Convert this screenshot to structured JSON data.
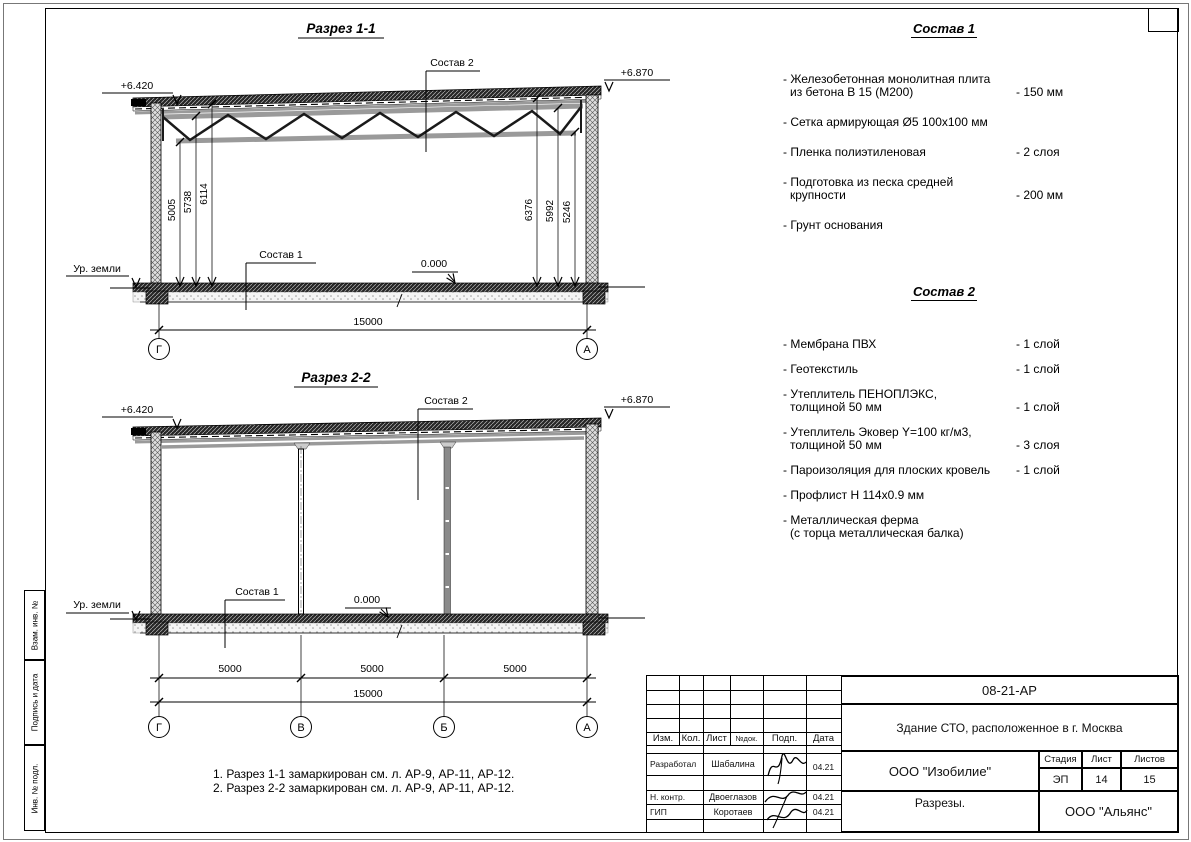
{
  "sheet": {
    "margin_label_1": "Взам. инв. №",
    "margin_label_2": "Подпись и дата",
    "margin_label_3": "Инв. № подл."
  },
  "section1": {
    "title": "Разрез 1-1",
    "level_left": "+6.420",
    "level_right": "+6.870",
    "leader_top": "Состав 2",
    "leader_floor": "Состав 1",
    "ground": "Ур. земли",
    "zero": "0.000",
    "dim_left_1": "5005",
    "dim_left_2": "5738",
    "dim_left_3": "6114",
    "dim_right_1": "6376",
    "dim_right_2": "5992",
    "dim_right_3": "5246",
    "dim_total": "15000",
    "axis_left": "Г",
    "axis_right": "А"
  },
  "section2": {
    "title": "Разрез 2-2",
    "level_left": "+6.420",
    "level_right": "+6.870",
    "leader_top": "Состав 2",
    "leader_floor": "Состав 1",
    "ground": "Ур. земли",
    "zero": "0.000",
    "span_1": "5000",
    "span_2": "5000",
    "span_3": "5000",
    "dim_total": "15000",
    "axis_1": "Г",
    "axis_2": "В",
    "axis_3": "Б",
    "axis_4": "А"
  },
  "sostav1": {
    "title": "Состав 1",
    "items": [
      {
        "line1": "- Железобетонная  монолитная плита",
        "line2": "из бетона В 15 (М200)",
        "value": "- 150 мм"
      },
      {
        "line1": "- Сетка армирующая Ø5 100x100 мм",
        "line2": "",
        "value": ""
      },
      {
        "line1": "- Пленка полиэтиленовая",
        "line2": "",
        "value": "-  2 слоя"
      },
      {
        "line1": "- Подготовка из песка средней",
        "line2": "крупности",
        "value": "- 200 мм"
      },
      {
        "line1": "- Грунт основания",
        "line2": "",
        "value": ""
      }
    ]
  },
  "sostav2": {
    "title": "Состав 2",
    "items": [
      {
        "line1": "- Мембрана ПВХ",
        "line2": "",
        "value": "- 1 слой"
      },
      {
        "line1": "- Геотекстиль",
        "line2": "",
        "value": "- 1 слой"
      },
      {
        "line1": "- Утеплитель ПЕНОПЛЭКС,",
        "line2": "толщиной 50 мм",
        "value": "- 1 слой"
      },
      {
        "line1": "- Утеплитель Эковер Y=100 кг/м3,",
        "line2": "толщиной 50 мм",
        "value": "- 3 слоя"
      },
      {
        "line1": "- Пароизоляция для плоских кровель",
        "line2": "",
        "value": "- 1 слой"
      },
      {
        "line1": "- Профлист Н 114x0.9 мм",
        "line2": "",
        "value": ""
      },
      {
        "line1": "- Металлическая ферма",
        "line2": "(с торца металлическая балка)",
        "value": ""
      }
    ]
  },
  "notes": {
    "n1": "1. Разрез 1-1 замаркирован см. л. АР-9, АР-11, АР-12.",
    "n2": "2. Разрез 2-2 замаркирован см. л. АР-9, АР-11, АР-12."
  },
  "titleblock": {
    "doc_number": "08-21-АР",
    "project": "Здание СТО, расположенное в г. Москва",
    "company": "ООО \"Изобилие\"",
    "sheet_name": "Разрезы.",
    "contractor": "ООО \"Альянс\"",
    "stage_label": "Стадия",
    "sheet_label": "Лист",
    "sheets_label": "Листов",
    "stage": "ЭП",
    "sheet_num": "14",
    "sheets_total": "15",
    "col_izm": "Изм.",
    "col_kol": "Кол.",
    "col_list": "Лист",
    "col_ndok": "№док.",
    "col_podp": "Подп.",
    "col_data": "Дата",
    "row1_role": "Разработал",
    "row1_name": "Шабалина",
    "row1_date": "04.21",
    "row2_role": "Н. контр.",
    "row2_name": "Двоеглазов",
    "row2_date": "04.21",
    "row3_role": "ГИП",
    "row3_name": "Коротаев",
    "row3_date": "04.21"
  }
}
